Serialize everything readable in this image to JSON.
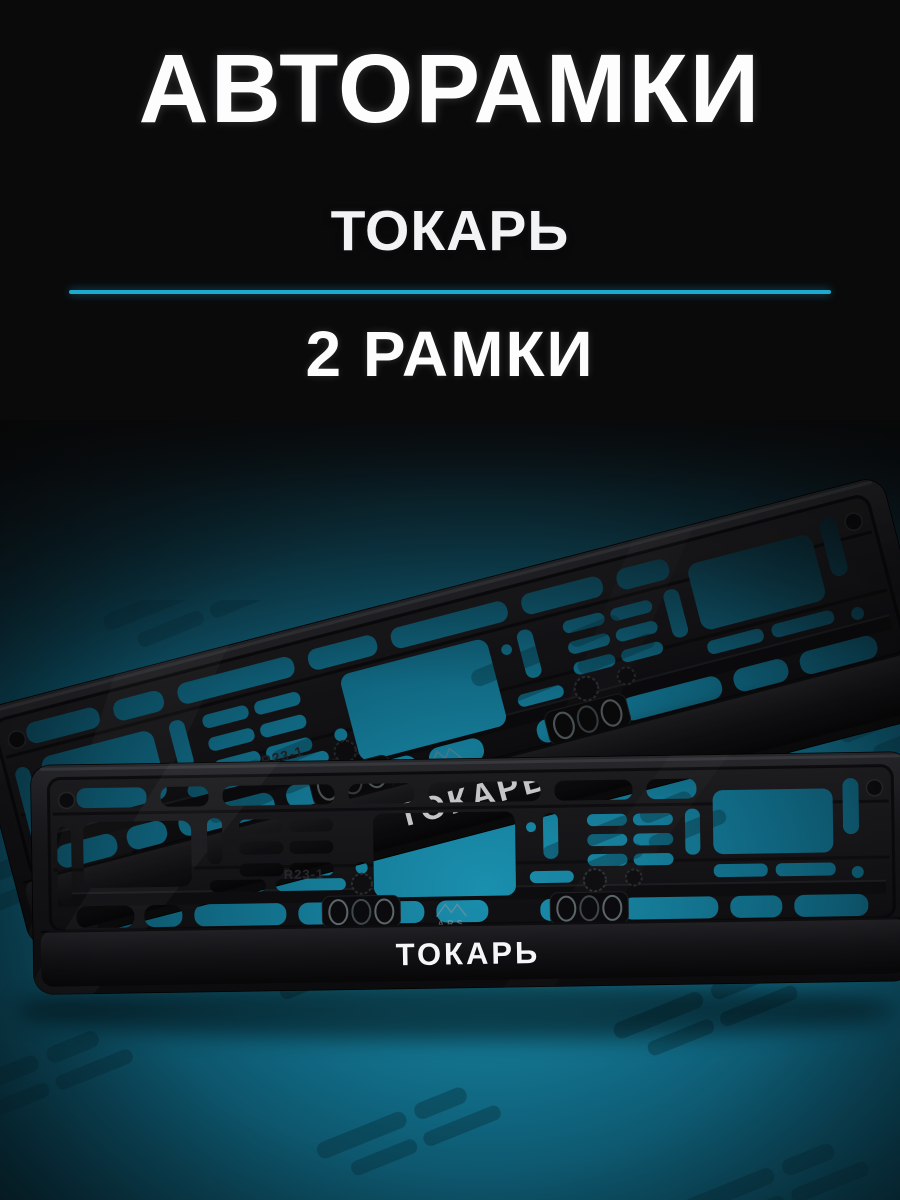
{
  "header": {
    "title": "АВТОРАМКИ",
    "model_name": "ТОКАРЬ",
    "quantity_label": "2 РАМКИ"
  },
  "product_photo": {
    "frame_bar_text": "ТОКАРЬ",
    "brand_mark": "ARS",
    "mold_mark": "R23-1",
    "frame_count": 2
  },
  "colors": {
    "divider_cyan": "#1ea9cd",
    "teal_glow": "#1a8fae",
    "background": "#0a0a0b",
    "frame_black": "#121214",
    "text_white": "#ffffff"
  }
}
